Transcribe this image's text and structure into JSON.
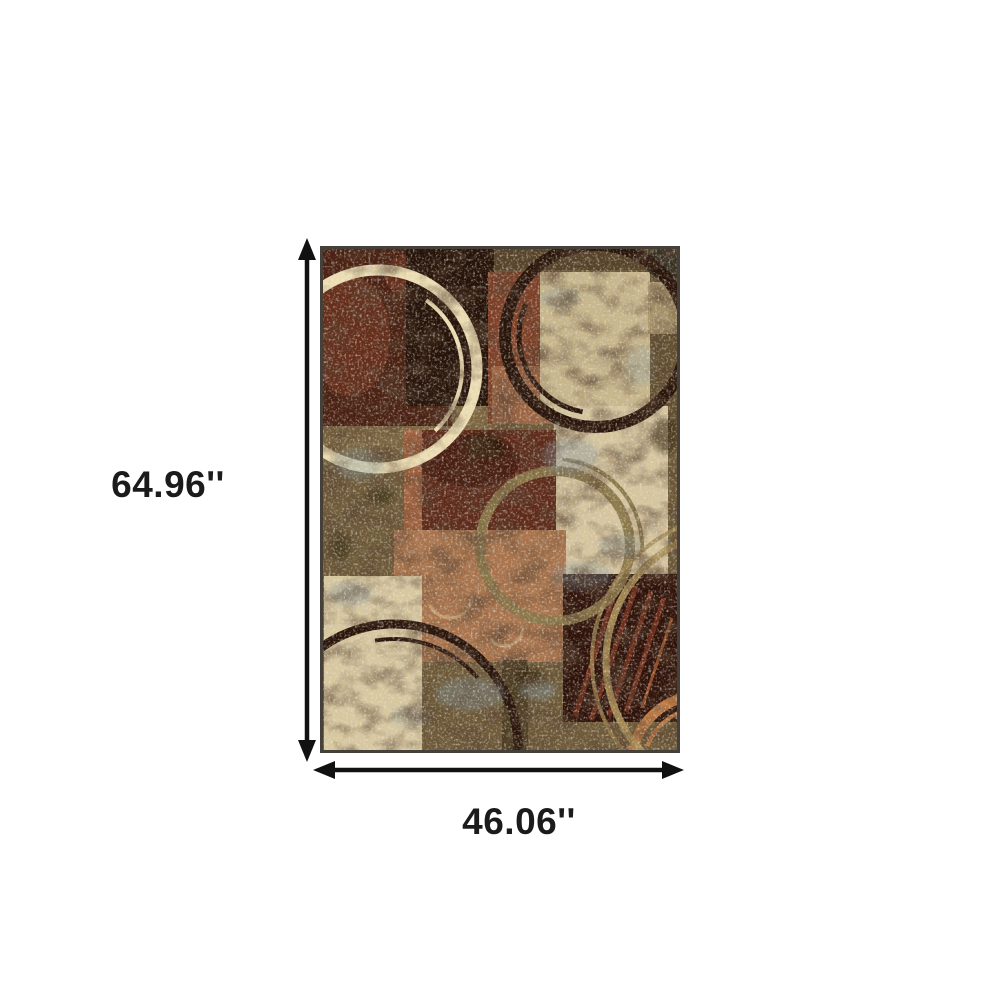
{
  "figure": {
    "type": "product-dimension-diagram",
    "product_description": "Abstract patchwork area rug in browns, rust, cream and olive with distressed painted circle motifs",
    "height_label": "64.96''",
    "width_label": "46.06''"
  },
  "colors": {
    "background": "#ffffff",
    "arrow": "#111111",
    "label_text": "#1b1b1b",
    "rug": {
      "base_olive": "#6f5b3a",
      "top_band": "#4a3820",
      "right_column": "#5a462a",
      "left_band": "#8a7148",
      "maroon_block": "#4a2113",
      "maroon_wash": "#7b3a22",
      "chocolate_block": "#261309",
      "brick_block": "#7e4028",
      "salmon_patch": "#a06a46",
      "beige_square": "#c8b68c",
      "cream_block": "#d6c59e",
      "rust_block": "#5f2b1b",
      "rust_left_strip": "#a96a44",
      "rust_mottle": "#34130a",
      "copper_block": "#a9744d",
      "maroon_streak_block": "#2f130a",
      "streak_rust": "#7a3420",
      "streak_orange": "#c06a3a",
      "cream_bottom_block": "#d8c8a0",
      "dark_strip": "#493920",
      "corner_beige": "#ab9870",
      "corner_dark": "#2c2a20",
      "swirl": "#d9c49a",
      "ring_cream": "#ecddb2",
      "ring_dark": "#2a150b",
      "ring_olive": "#8a7749",
      "ring_orange": "#c07b43",
      "ring_tan": "#ac9158",
      "ring_tan2": "#a18550",
      "speckle_blue": "#7f929b",
      "speckle_dark": "#1d1208",
      "border": "#45403a"
    }
  }
}
